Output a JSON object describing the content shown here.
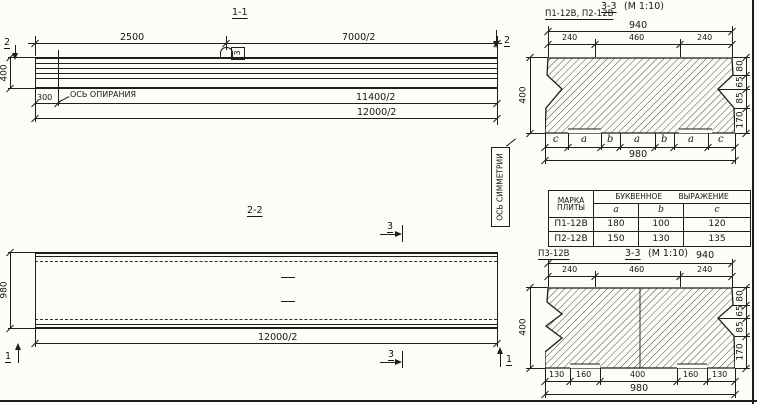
{
  "view11": {
    "title": "1-1",
    "dim_2500": "2500",
    "dim_7000": "7000/2",
    "dim_400": "400",
    "dim_300": "300",
    "support_axis_label": "ОСЬ ОПИРАНИЯ",
    "dim_11400": "11400/2",
    "dim_12000": "12000/2",
    "marker_left": "2",
    "marker_right": "2",
    "loop_callout": "3"
  },
  "view22": {
    "title": "2-2",
    "dim_980": "980",
    "dim_12000": "12000/2",
    "marker_3_top": "3",
    "marker_3_bottom": "3",
    "marker_1_left": "1",
    "marker_1_right": "1",
    "symmetry_label": "ОСЬ СИММЕТРИИ"
  },
  "section_top": {
    "plates_label": "П1-12В, П2-12В",
    "title": "3-3",
    "scale": "(М 1:10)",
    "dim_940": "940",
    "dims_top": [
      "240",
      "460",
      "240"
    ],
    "dim_400": "400",
    "dims_right": [
      "80",
      "65",
      "85",
      "170"
    ],
    "letters": [
      "c",
      "a",
      "b",
      "a",
      "b",
      "a",
      "c"
    ],
    "dim_980": "980"
  },
  "section_bottom": {
    "plate_label": "П3-12В",
    "title": "3-3",
    "scale": "(М 1:10)",
    "dim_940": "940",
    "dims_top": [
      "240",
      "460",
      "240"
    ],
    "dim_400": "400",
    "dims_right": [
      "80",
      "65",
      "85",
      "170"
    ],
    "dims_bottom": [
      "130",
      "160",
      "400",
      "160",
      "130"
    ],
    "dim_980": "980"
  },
  "table": {
    "header_mark1": "МАРКА",
    "header_mark2": "ПЛИТЫ",
    "header_expr": "БУКВЕННОЕ ВЫРАЖЕНИЕ",
    "col_a": "a",
    "col_b": "b",
    "col_c": "c",
    "rows": [
      {
        "mark": "П1-12В",
        "a": "180",
        "b": "100",
        "c": "120"
      },
      {
        "mark": "П2-12В",
        "a": "150",
        "b": "130",
        "c": "135"
      }
    ]
  }
}
